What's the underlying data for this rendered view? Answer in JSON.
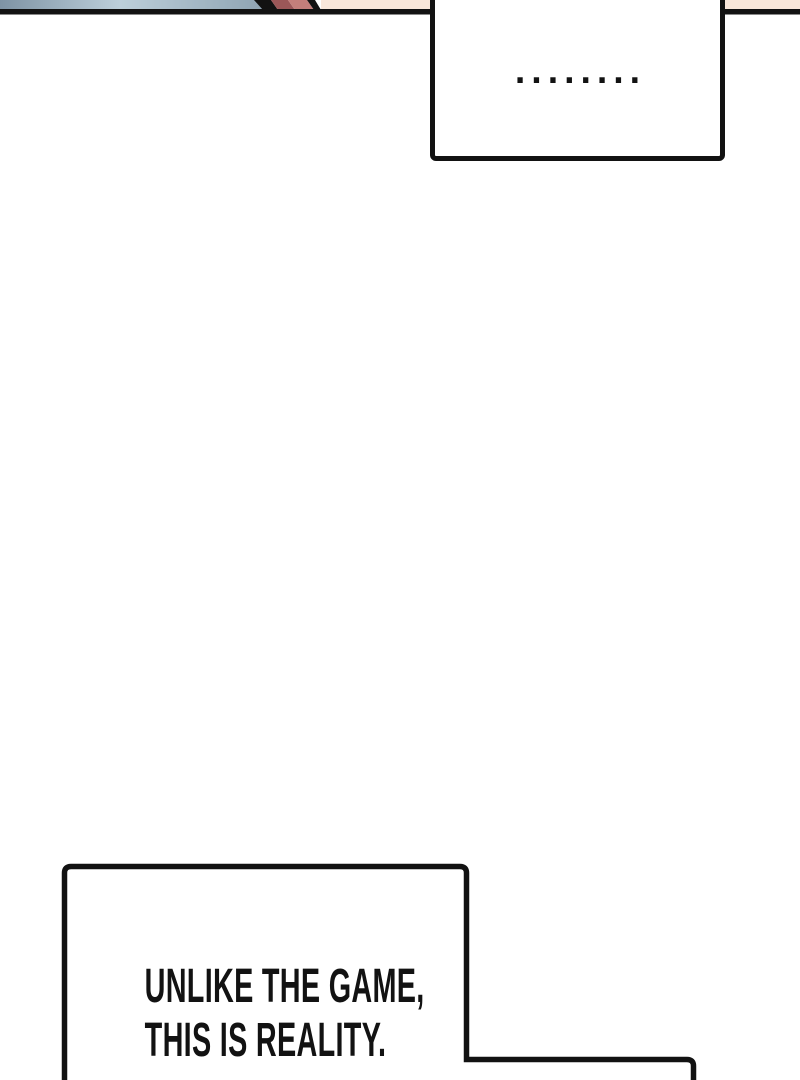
{
  "page": {
    "background": "#ffffff",
    "ink": "#121212"
  },
  "top_panel": {
    "colors": {
      "blue_left": "#7e93a4",
      "blue_mid": "#bccfda",
      "blue_right": "#8ea3b2",
      "maroon": "#9b5758",
      "rose": "#c37f7b",
      "peach": "#f9e7da",
      "outline": "#121212"
    }
  },
  "bubbles": {
    "top": {
      "text": "........"
    },
    "bottom": {
      "lines": [
        "UNLIKE THE GAME,",
        "THIS IS REALITY."
      ]
    }
  }
}
